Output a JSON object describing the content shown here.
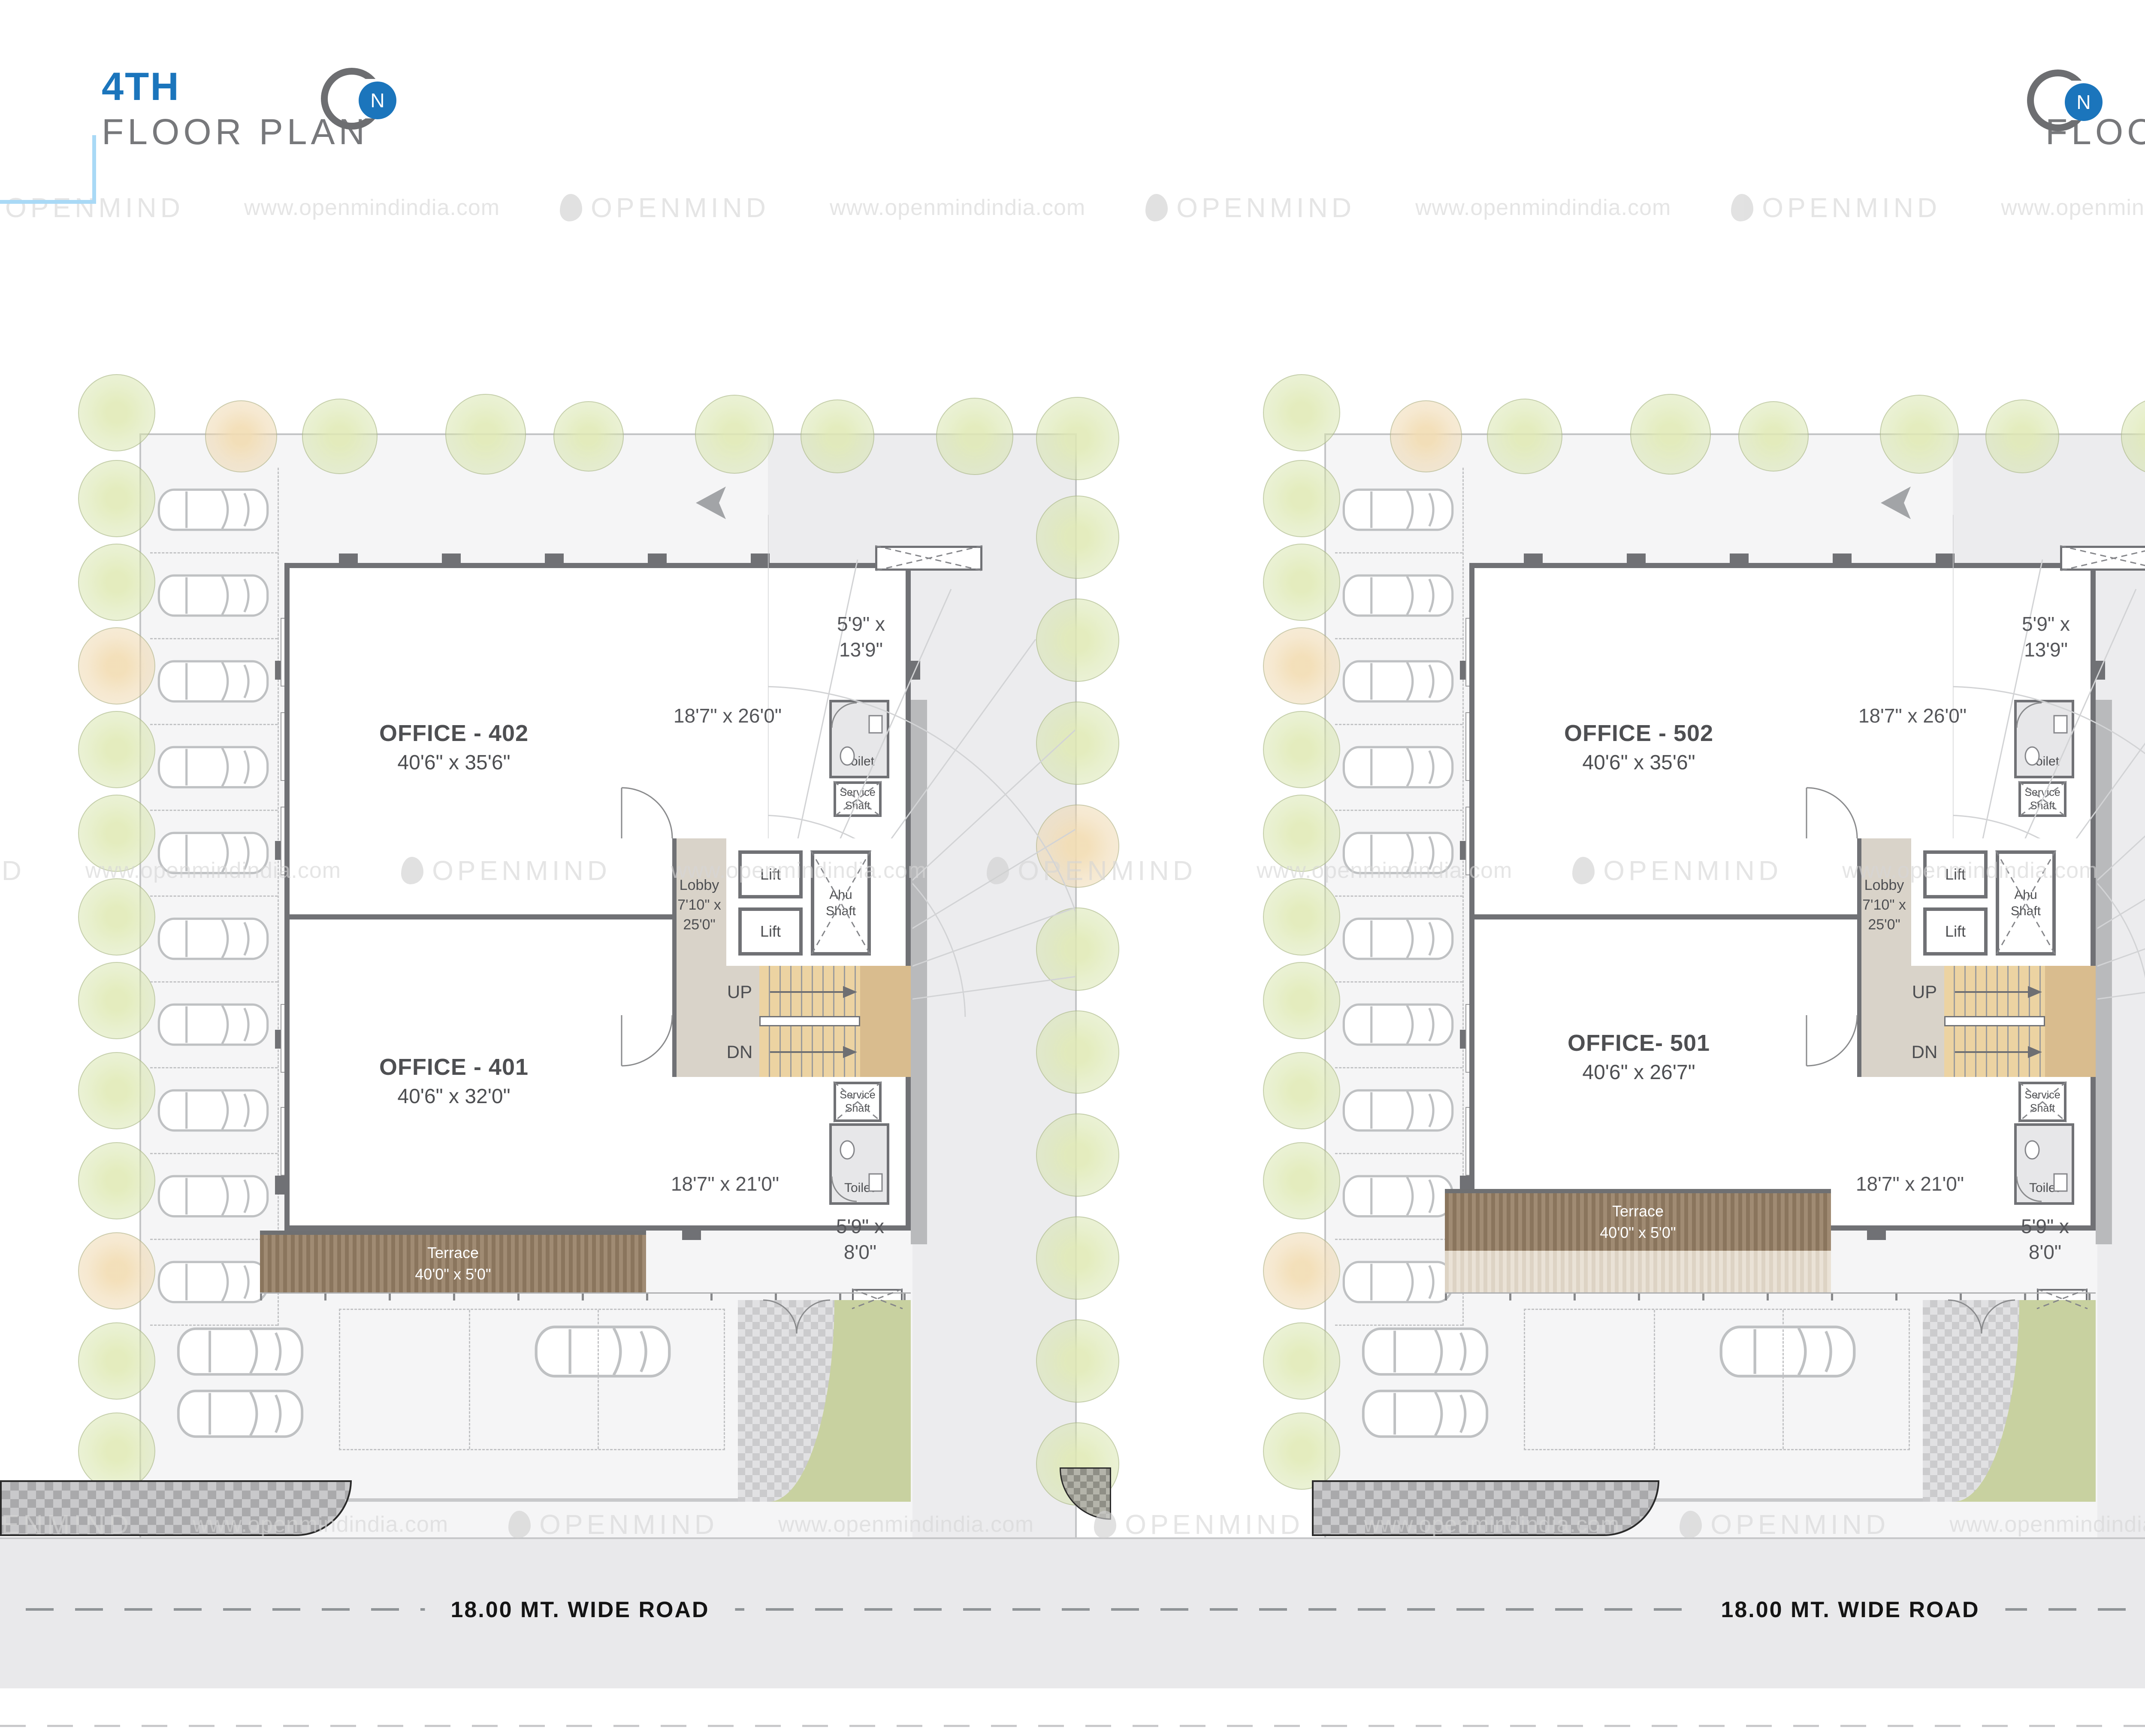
{
  "header": {
    "left": {
      "num": "4TH",
      "label": "FLOOR PLAN"
    },
    "right": {
      "num": "5TH",
      "label": "FLOOR PLAN"
    },
    "north": "N"
  },
  "watermark": {
    "brand": "OPENMIND",
    "url": "www.openmindindia.com"
  },
  "road": {
    "label": "18.00 MT. WIDE ROAD"
  },
  "colors": {
    "accent_blue": "#1b75bc",
    "bracket_left": "#a9d9f6",
    "bracket_right": "#35a3dc",
    "wall_gray": "#707175",
    "terrace_brown": "#96816a",
    "stair_tan": "#ecd3a2",
    "lobby_beige": "#d9d3c9",
    "lawn_green": "#c8d1a0"
  },
  "plans": [
    {
      "name": "4TH FLOOR PLAN",
      "office_top": {
        "label": "OFFICE - 402",
        "dims": "40'6\" x 35'6\""
      },
      "office_bottom": {
        "label": "OFFICE - 401",
        "dims": "40'6\" x 32'0\""
      },
      "lobby": {
        "l1": "Lobby",
        "l2": "7'10\" x",
        "l3": "25'0\""
      },
      "lift": "Lift",
      "ahu": {
        "l1": "Ahu",
        "l2": "Shaft"
      },
      "service": {
        "l1": "Service",
        "l2": "Shaft"
      },
      "toilet": "Toilet",
      "stairs": {
        "up": "UP",
        "dn": "DN"
      },
      "terrace": {
        "l1": "Terrace",
        "l2": "40'0\" x 5'0\""
      },
      "dims": {
        "top": "18'7\" x 26'0\"",
        "corner_top_1": "5'9\" x",
        "corner_top_2": "13'9\"",
        "bottom": "18'7\" x 21'0\"",
        "corner_bottom_1": "5'9\" x",
        "corner_bottom_2": "8'0\""
      }
    },
    {
      "name": "5TH FLOOR PLAN",
      "office_top": {
        "label": "OFFICE - 502",
        "dims": "40'6\" x 35'6\""
      },
      "office_bottom": {
        "label": "OFFICE- 501",
        "dims": "40'6\" x 26'7\""
      },
      "lobby": {
        "l1": "Lobby",
        "l2": "7'10\" x",
        "l3": "25'0\""
      },
      "lift": "Lift",
      "ahu": {
        "l1": "Ahu",
        "l2": "Shaft"
      },
      "service": {
        "l1": "Service",
        "l2": "Shaft"
      },
      "toilet": "Toilet",
      "stairs": {
        "up": "UP",
        "dn": "DN"
      },
      "terrace": {
        "l1": "Terrace",
        "l2": "40'0\" x 5'0\""
      },
      "dims": {
        "top": "18'7\" x 26'0\"",
        "corner_top_1": "5'9\" x",
        "corner_top_2": "13'9\"",
        "bottom": "18'7\" x 21'0\"",
        "corner_bottom_1": "5'9\" x",
        "corner_bottom_2": "8'0\""
      }
    }
  ]
}
